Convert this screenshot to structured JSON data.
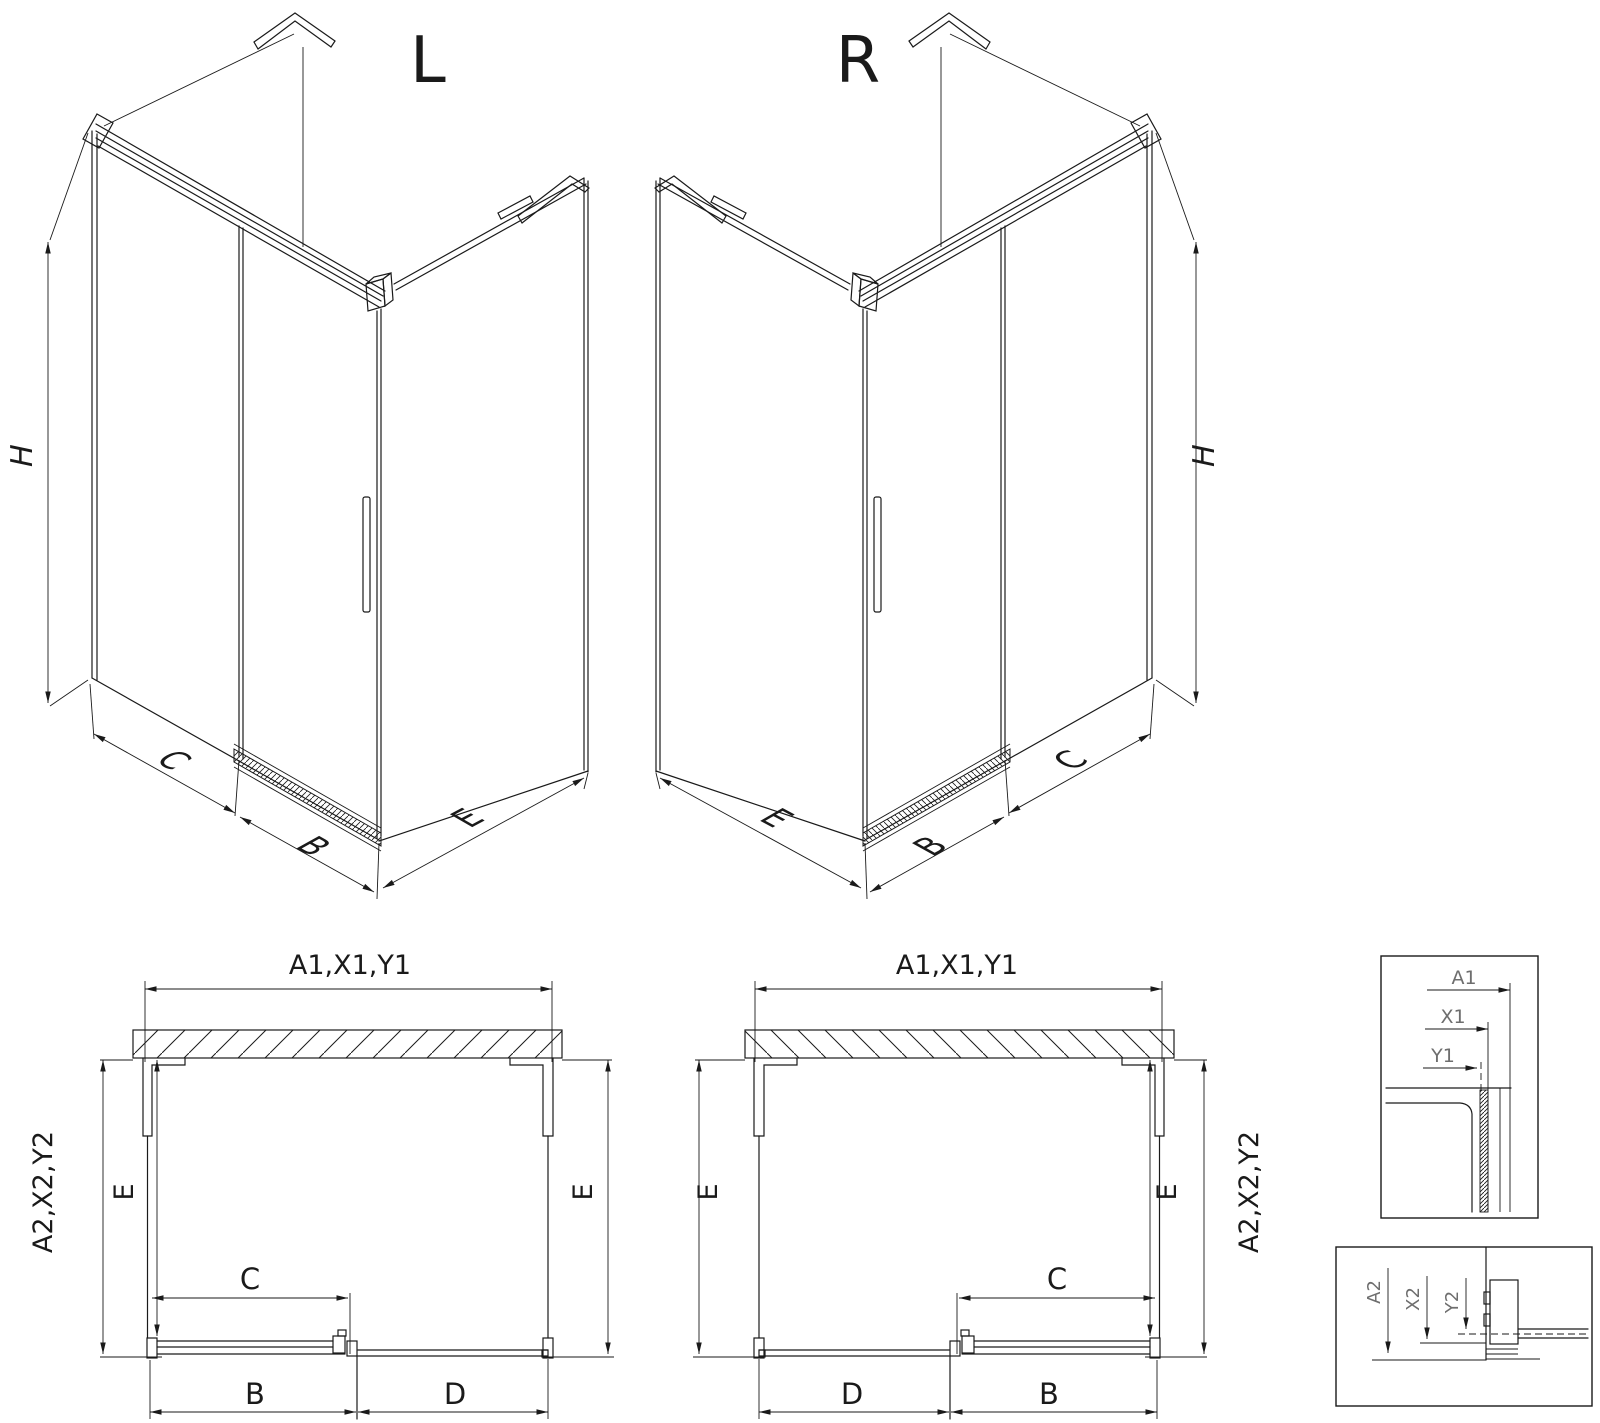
{
  "drawing": {
    "iso_left": {
      "title": "L",
      "h": "H",
      "c": "C",
      "b": "B",
      "e": "E"
    },
    "iso_right": {
      "title": "R",
      "h": "H",
      "c": "C",
      "b": "B",
      "e": "E"
    },
    "plan_left": {
      "top": "A1,X1,Y1",
      "side": "A2,X2,Y2",
      "e_left": "E",
      "e_right": "E",
      "c": "C",
      "b": "B",
      "d": "D"
    },
    "plan_right": {
      "top": "A1,X1,Y1",
      "side": "A2,X2,Y2",
      "e_left": "E",
      "e_right": "E",
      "c": "C",
      "b": "B",
      "d": "D"
    },
    "detail_top": {
      "a1": "A1",
      "x1": "X1",
      "y1": "Y1"
    },
    "detail_bottom": {
      "a2": "A2",
      "x2": "X2",
      "y2": "Y2"
    }
  },
  "colors": {
    "line": "#1a1a1a",
    "detail_text": "#6e6e6e",
    "background": "#ffffff"
  }
}
